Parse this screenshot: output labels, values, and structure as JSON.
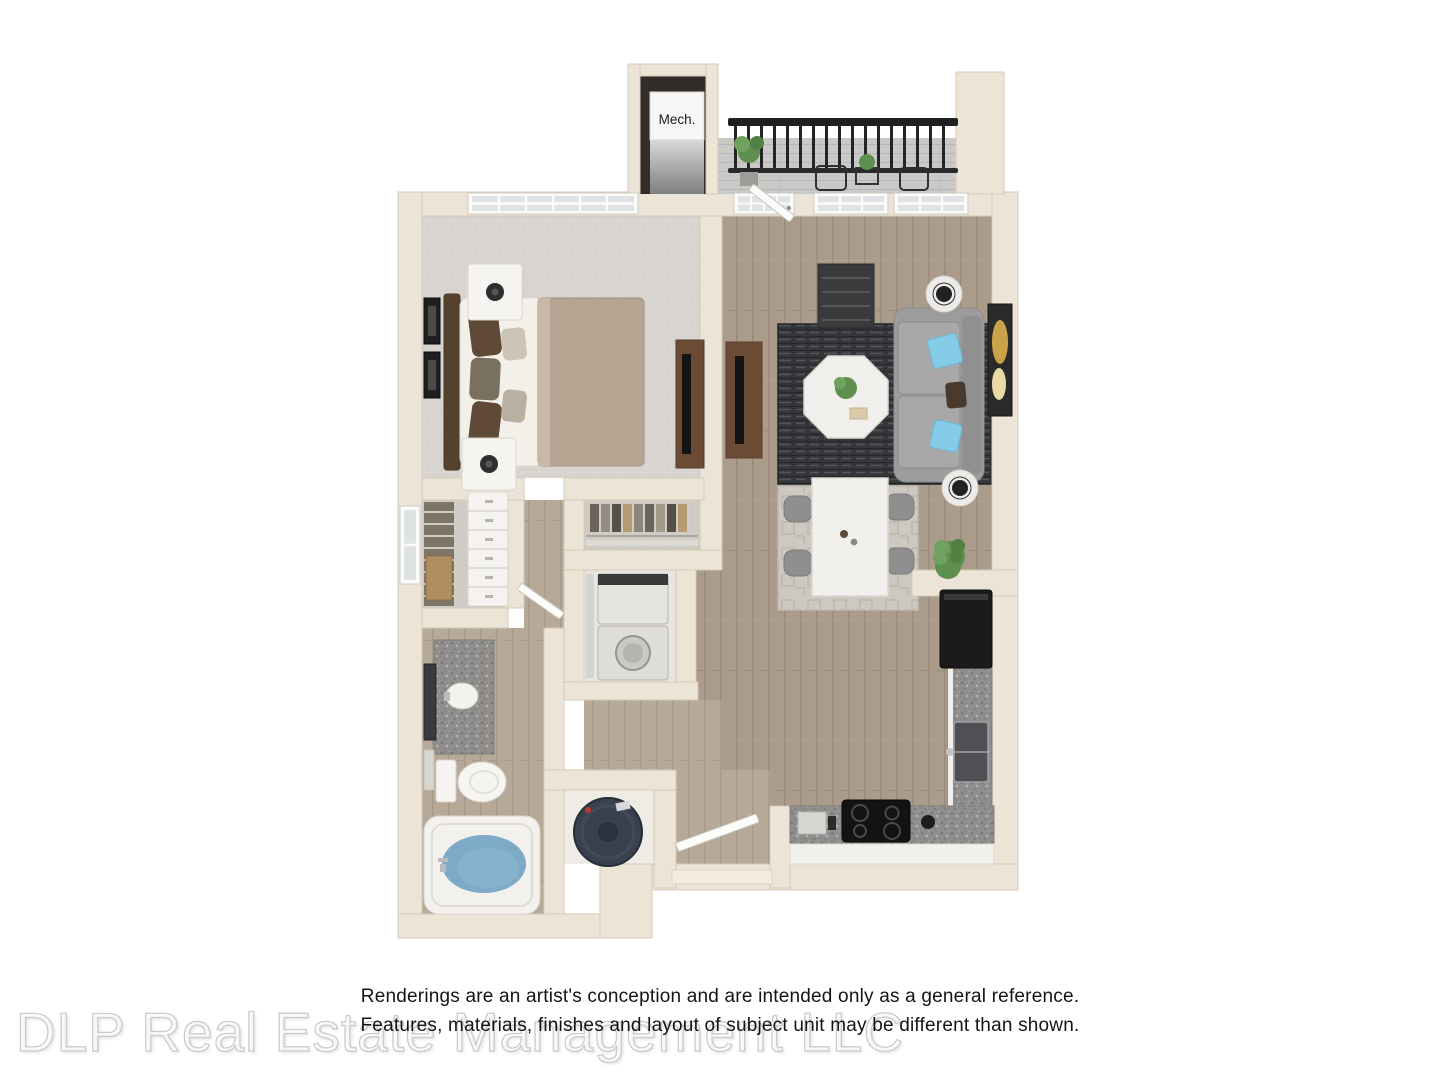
{
  "floorplan": {
    "mech_label": "Mech.",
    "colors": {
      "wall": "#ece4d7",
      "wall_edge": "#d5cab7",
      "wood_floor": "#aa9b8a",
      "bath_floor": "#b7a998",
      "bedroom_carpet": "#d8d4cf",
      "balcony_floor": "#c9c9c7",
      "granite_counter": "#8f8e8c",
      "rug_dark": "#35363a",
      "rug_light": "#cdc9c0",
      "marble": "#f2f0ec",
      "sofa_gray": "#9c9c9c",
      "accent_pillow_blue": "#84cbe7",
      "bed_duvet_tan": "#b6a593",
      "console_wood": "#6b4b33",
      "appliance_black": "#1b1b1d",
      "tub_water_blue": "#7daac7",
      "water_heater_navy": "#39414f",
      "plant_green": "#5d8f4e",
      "railing_black": "#202022",
      "watermark_gray": "#cbcbcb",
      "disclaimer_text": "#141414"
    }
  },
  "disclaimer": {
    "line1": "Renderings are an artist's conception and are intended only as a general reference.",
    "line2": "Features, materials, finishes and layout of subject unit may be different than shown."
  },
  "watermark": {
    "text": "DLP Real Estate Management LLC"
  }
}
